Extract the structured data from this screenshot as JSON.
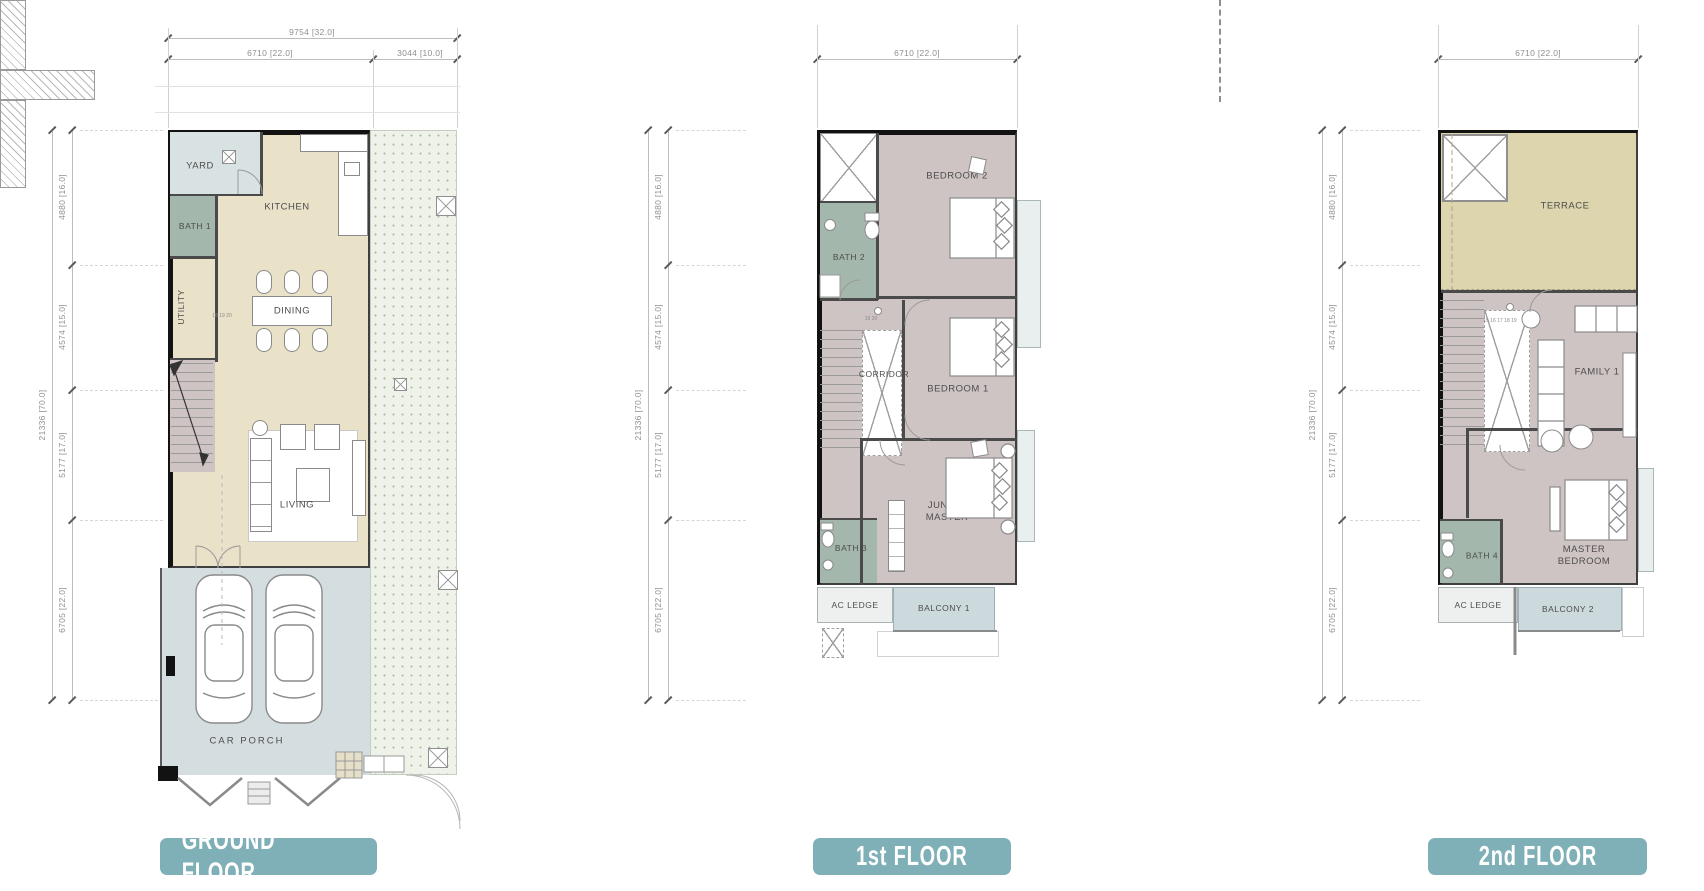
{
  "sheet": {
    "background": "#ffffff"
  },
  "colors": {
    "accent_teal": "#7fb0b7",
    "wall_black": "#121212",
    "floor_beige": "#e9e1c8",
    "floor_mauve": "#cfc4c4",
    "bath_green": "#a4b7ac",
    "porch_grey_blue": "#d4dde0",
    "yard_blue": "#d9e2e3",
    "balcony_blue": "#ccdade",
    "terrace_khaki": "#ddd5ae",
    "garden_dotted": "#eef2e8",
    "dim_text_grey": "#8f8f8f"
  },
  "dims_left": {
    "overall": "21336 [70.0]",
    "segments": [
      "4880 [16.0]",
      "4574 [15.0]",
      "5177 [17.0]",
      "6705 [22.0]"
    ]
  },
  "panels": {
    "ground": {
      "badge": "GROUND FLOOR",
      "dims_top": {
        "overall": "9754 [32.0]",
        "left": "6710 [22.0]",
        "right": "3044 [10.0]"
      },
      "rooms": {
        "yard": "YARD",
        "bath1": "BATH 1",
        "kitchen": "KITCHEN",
        "utility": "UTILITY",
        "dining": "DINING",
        "living": "LIVING",
        "carporch": "CAR PORCH"
      },
      "stair_numbers": "18 19 20"
    },
    "first": {
      "badge": "1st FLOOR",
      "dims_top": {
        "width": "6710 [22.0]"
      },
      "rooms": {
        "bedroom2": "BEDROOM 2",
        "bath2": "BATH 2",
        "corridor": "CORRIDOR",
        "bedroom1": "BEDROOM 1",
        "junior": "JUNIOR MASTER",
        "bath3": "BATH 3",
        "acledge": "AC LEDGE",
        "balcony1": "BALCONY 1"
      },
      "stair_numbers": "19 20"
    },
    "second": {
      "badge": "2nd FLOOR",
      "dims_top": {
        "width": "6710 [22.0]"
      },
      "rooms": {
        "terrace": "TERRACE",
        "family": "FAMILY 1",
        "bath4": "BATH 4",
        "master": "MASTER BEDROOM",
        "acledge": "AC LEDGE",
        "balcony2": "BALCONY 2"
      },
      "stair_numbers": "15 16 17 18 19"
    }
  }
}
